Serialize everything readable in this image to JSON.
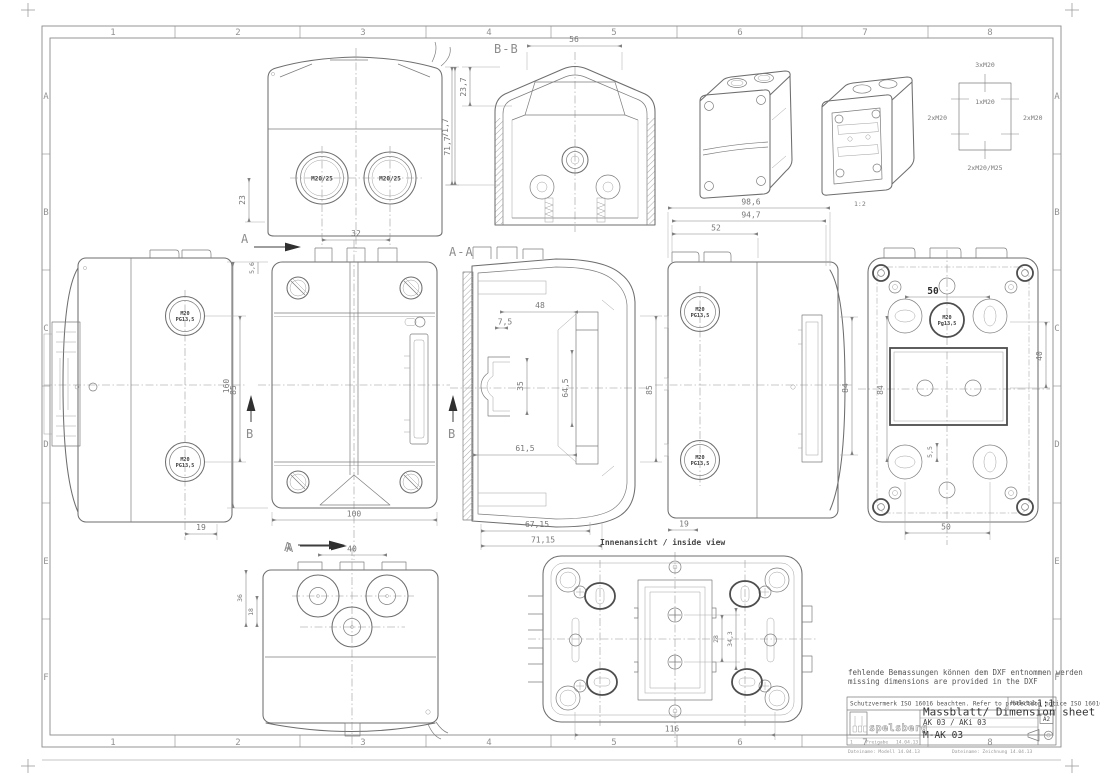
{
  "frame": {
    "cols": [
      "1",
      "2",
      "3",
      "4",
      "5",
      "6",
      "7",
      "8"
    ],
    "rows": [
      "A",
      "B",
      "C",
      "D",
      "E",
      "F"
    ]
  },
  "sections": {
    "a": "A",
    "b": "B",
    "aa": "A-A",
    "bb": "B-B"
  },
  "notes": {
    "de": "fehlende Bemassungen können dem DXF entnommen werden",
    "en": "missing dimensions are provided in the DXF",
    "inside_view": "Innenansicht / inside view",
    "iso_scale": "1:2"
  },
  "knockouts": {
    "top": "3xM20",
    "center": "1xM20",
    "left": "2xM20",
    "right": "2xM20",
    "bottom": "2xM20/M25"
  },
  "glands": {
    "front": "M20/25",
    "side_l1": "M20",
    "side_l2": "PG13,5",
    "rear_l1": "M20",
    "rear_l2": "Pg13,5"
  },
  "dims": {
    "front_elev": {
      "spacing": "32",
      "height": "71,7",
      "offset": "23"
    },
    "section_bb": {
      "width": "56",
      "upper": "23,7",
      "height": "71,7"
    },
    "left_side": {
      "spacing": "85",
      "offset": "19"
    },
    "front": {
      "width": "100",
      "height": "160",
      "lip": "5,6"
    },
    "section_aa": {
      "d48": "48",
      "d75": "7,5",
      "d35": "35",
      "d645": "64,5",
      "d615": "61,5",
      "d85": "85",
      "d6715": "67,15",
      "d7115": "71,15"
    },
    "right_side": {
      "d986": "98,6",
      "d947": "94,7",
      "d52": "52",
      "d84": "84",
      "d19": "19"
    },
    "rear": {
      "top": "50",
      "d84": "84",
      "d40": "40",
      "d55": "5,5",
      "bottom": "50"
    },
    "bottom_view": {
      "d40": "40",
      "d36": "36",
      "d18": "18"
    },
    "inside_view": {
      "d28": "28",
      "d343": "34,3",
      "d116": "116"
    }
  },
  "title_block": {
    "protection": "Schutzvermerk ISO 16016 beachten. Refer to protection notice ISO 16016.",
    "scale_label": "Maßstab",
    "scale_value": "1:1",
    "title": "Massblatt/ Dimension sheet",
    "product": "AK 03 / AKi 03",
    "doc_no": "M-AK 03",
    "format": "A2",
    "brand": "spelsberg",
    "rev_no": "1",
    "rev_label": "Freigabe",
    "rev_date": "14.04.13",
    "file_model": "Dateiname: Modell  14.04.13",
    "file_drawing": "Dateiname: Zeichnung  14.04.13"
  },
  "colors": {
    "outline_grey": "#6e6e6e",
    "dimension_grey": "#868686",
    "dark_text": "#333333",
    "paper": "#ffffff"
  }
}
